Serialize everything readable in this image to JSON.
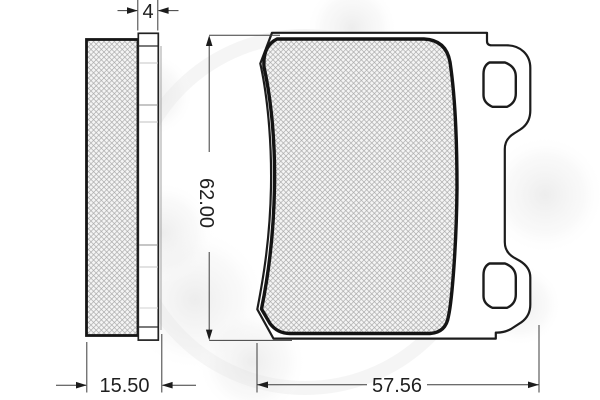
{
  "drawing": {
    "kind": "technical-drawing-2-views",
    "dimensions": {
      "backplate_thickness": "4",
      "total_thickness": "15.50",
      "height": "62.00",
      "width": "57.56"
    },
    "colors": {
      "outline": "#1c1c1c",
      "pad_outline": "#161616",
      "dimension_line": "#3c3c3c",
      "hatch_line": "#a6a6a6",
      "hatch_fill": "#f5f5f5",
      "background": "#ffffff",
      "watermark": "#e4e4e4"
    }
  }
}
